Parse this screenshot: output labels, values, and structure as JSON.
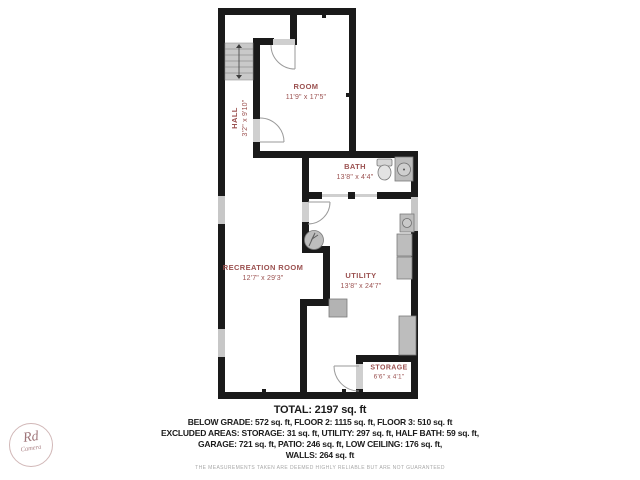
{
  "floor_plan": {
    "rooms": [
      {
        "id": "room",
        "name": "ROOM",
        "dims": "11'9\" x 17'5\""
      },
      {
        "id": "hall",
        "name": "HALL",
        "dims": "3'2\" x 9'10\""
      },
      {
        "id": "bath",
        "name": "BATH",
        "dims": "13'8\" x 4'4\""
      },
      {
        "id": "recreation-room",
        "name": "RECREATION ROOM",
        "dims": "12'7\" x 29'3\""
      },
      {
        "id": "utility",
        "name": "UTILITY",
        "dims": "13'8\" x 24'7\""
      },
      {
        "id": "storage",
        "name": "STORAGE",
        "dims": "6'6\" x 4'1\""
      }
    ],
    "colors": {
      "wall": "#1a1a1a",
      "room_label": "#9b5150",
      "window_fill": "#c7c7c7",
      "door_jamb": "#cfcfcf",
      "fixture_fill": "#bdbdbd",
      "fixture_stroke": "#7a7a7a",
      "door_arc": "#9a9a9a"
    }
  },
  "summary": {
    "total": "TOTAL: 2197 sq. ft",
    "line1": "BELOW GRADE: 572 sq. ft, FLOOR 2: 1115 sq. ft, FLOOR 3: 510 sq. ft",
    "line2": "EXCLUDED AREAS: STORAGE: 31 sq. ft, UTILITY: 297 sq. ft, HALF BATH: 59 sq. ft,",
    "line3": "GARAGE: 721 sq. ft, PATIO: 246 sq. ft, LOW CEILING: 176 sq. ft,",
    "line4": "WALLS: 264 sq. ft",
    "disclaimer": "THE MEASUREMENTS TAKEN ARE DEEMED HIGHLY RELIABLE BUT ARE NOT GUARANTEED"
  },
  "logo": {
    "monogram": "Rd",
    "name": "Camera"
  }
}
